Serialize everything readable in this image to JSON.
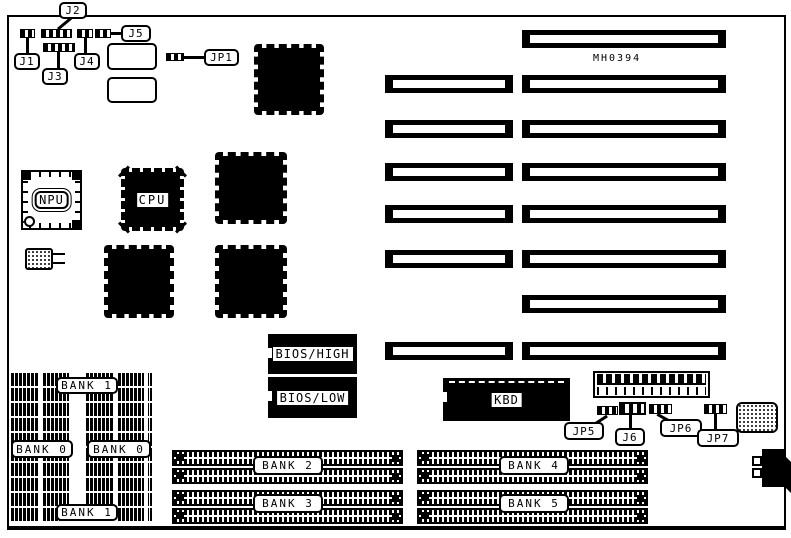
{
  "model": "MH0394",
  "jumpers": {
    "j1": "J1",
    "j2": "J2",
    "j3": "J3",
    "j4": "J4",
    "j5": "J5",
    "jp1": "JP1",
    "jp5": "JP5",
    "j6": "J6",
    "jp6": "JP6",
    "jp7": "JP7"
  },
  "chips": {
    "npu": "NPU",
    "cpu": "CPU",
    "bios_high": "BIOS/HIGH",
    "bios_low": "BIOS/LOW",
    "kbd": "KBD"
  },
  "banks": {
    "bank1_top": "BANK 1",
    "bank0_left": "BANK 0",
    "bank0_right": "BANK 0",
    "bank1_bottom": "BANK 1",
    "bank2": "BANK 2",
    "bank3": "BANK 3",
    "bank4": "BANK 4",
    "bank5": "BANK 5"
  },
  "colors": {
    "ink": "#000000",
    "paper": "#ffffff"
  }
}
